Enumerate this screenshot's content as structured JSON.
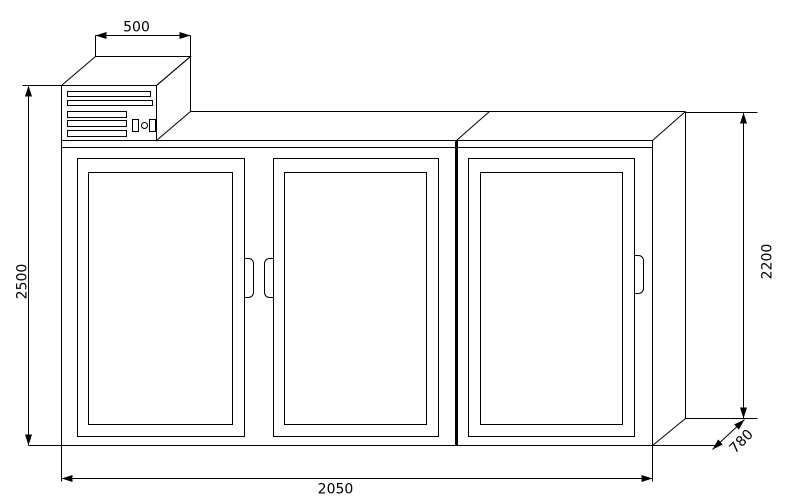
{
  "drawing": {
    "type": "technical-drawing",
    "object": "three-door cabinet with top-mounted compressor unit",
    "colors": {
      "line": "#000000",
      "background": "#ffffff"
    },
    "dimensions": {
      "unit_width": "500",
      "overall_height": "2500",
      "body_height": "2200",
      "depth": "780",
      "overall_width": "2050"
    }
  }
}
